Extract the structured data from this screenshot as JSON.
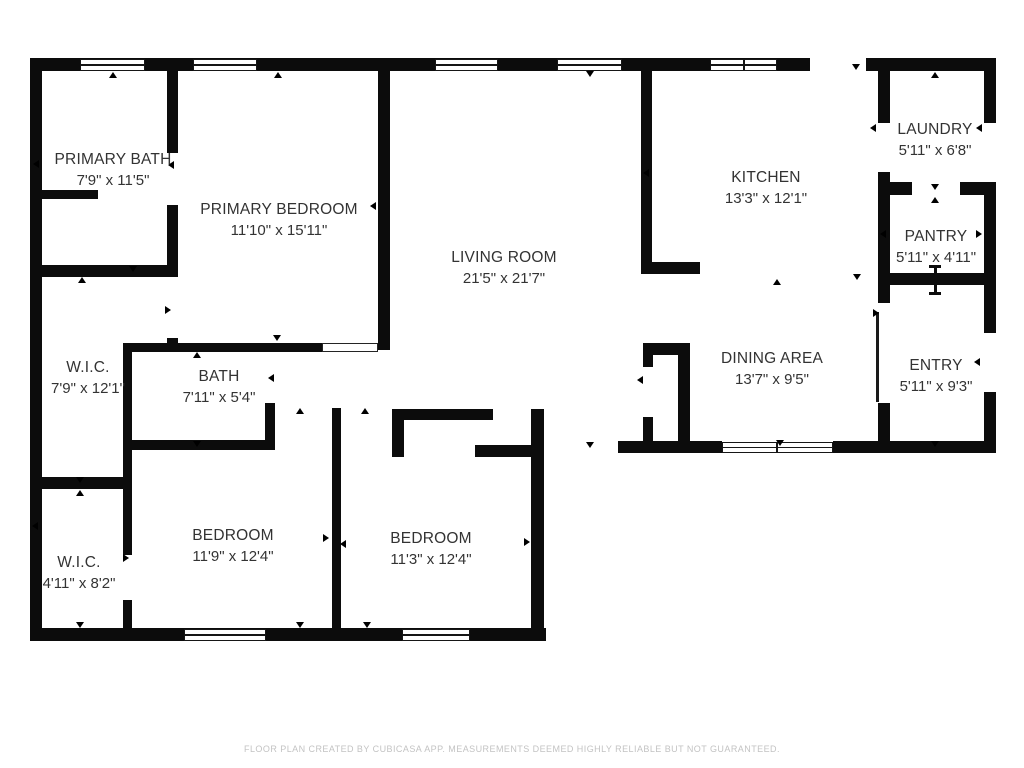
{
  "footer": {
    "text": "FLOOR PLAN CREATED BY CUBICASA APP. MEASUREMENTS DEEMED HIGHLY RELIABLE BUT NOT GUARANTEED."
  },
  "colors": {
    "wall": "#0c0c0c",
    "room_text": "#333333",
    "footer_text": "#c3c3c3",
    "background": "#ffffff"
  },
  "rooms": [
    {
      "name": "PRIMARY BATH",
      "dims": "7'9\" x 11'5\"",
      "cx": 113,
      "cy": 170
    },
    {
      "name": "PRIMARY BEDROOM",
      "dims": "11'10\" x 15'11\"",
      "cx": 279,
      "cy": 220
    },
    {
      "name": "LIVING ROOM",
      "dims": "21'5\" x 21'7\"",
      "cx": 504,
      "cy": 268
    },
    {
      "name": "KITCHEN",
      "dims": "13'3\" x 12'1\"",
      "cx": 766,
      "cy": 188
    },
    {
      "name": "LAUNDRY",
      "dims": "5'11\" x 6'8\"",
      "cx": 935,
      "cy": 140
    },
    {
      "name": "PANTRY",
      "dims": "5'11\" x 4'11\"",
      "cx": 936,
      "cy": 247
    },
    {
      "name": "ENTRY",
      "dims": "5'11\" x 9'3\"",
      "cx": 936,
      "cy": 376
    },
    {
      "name": "DINING AREA",
      "dims": "13'7\" x 9'5\"",
      "cx": 772,
      "cy": 369
    },
    {
      "name": "W.I.C.",
      "dims": "7'9\" x 12'1\"",
      "cx": 88,
      "cy": 378
    },
    {
      "name": "BATH",
      "dims": "7'11\" x 5'4\"",
      "cx": 219,
      "cy": 387
    },
    {
      "name": "W.I.C.",
      "dims": "4'11\" x 8'2\"",
      "cx": 79,
      "cy": 573
    },
    {
      "name": "BEDROOM",
      "dims": "11'9\" x 12'4\"",
      "cx": 233,
      "cy": 546
    },
    {
      "name": "BEDROOM",
      "dims": "11'3\" x 12'4\"",
      "cx": 431,
      "cy": 549
    }
  ],
  "plan": {
    "walls": [
      [
        30,
        58,
        780,
        13
      ],
      [
        866,
        58,
        130,
        13
      ],
      [
        30,
        58,
        12,
        583
      ],
      [
        30,
        628,
        516,
        13
      ],
      [
        984,
        58,
        12,
        65
      ],
      [
        984,
        185,
        12,
        148
      ],
      [
        984,
        392,
        12,
        61
      ],
      [
        618,
        441,
        104,
        12
      ],
      [
        833,
        441,
        163,
        12
      ],
      [
        531,
        409,
        13,
        232
      ],
      [
        167,
        58,
        11,
        95
      ],
      [
        167,
        205,
        11,
        72
      ],
      [
        167,
        338,
        11,
        14
      ],
      [
        30,
        190,
        68,
        9
      ],
      [
        30,
        265,
        148,
        12
      ],
      [
        123,
        343,
        199,
        9
      ],
      [
        123,
        343,
        9,
        212
      ],
      [
        123,
        600,
        9,
        41
      ],
      [
        30,
        477,
        101,
        12
      ],
      [
        265,
        403,
        10,
        47
      ],
      [
        123,
        440,
        147,
        10
      ],
      [
        332,
        408,
        9,
        233
      ],
      [
        392,
        409,
        101,
        11
      ],
      [
        392,
        420,
        12,
        37
      ],
      [
        475,
        445,
        56,
        12
      ],
      [
        378,
        58,
        12,
        292
      ],
      [
        641,
        58,
        11,
        216
      ],
      [
        641,
        262,
        59,
        12
      ],
      [
        643,
        343,
        47,
        12
      ],
      [
        643,
        343,
        10,
        24
      ],
      [
        643,
        417,
        10,
        36
      ],
      [
        678,
        343,
        12,
        110
      ],
      [
        878,
        71,
        12,
        52
      ],
      [
        878,
        172,
        12,
        131
      ],
      [
        878,
        403,
        12,
        50
      ],
      [
        878,
        182,
        34,
        13
      ],
      [
        960,
        182,
        36,
        13
      ],
      [
        878,
        273,
        118,
        12
      ]
    ],
    "windows": [
      [
        80,
        59,
        65,
        12
      ],
      [
        193,
        59,
        64,
        12
      ],
      [
        435,
        59,
        63,
        12
      ],
      [
        557,
        59,
        65,
        12
      ],
      [
        710,
        59,
        34,
        12
      ],
      [
        744,
        59,
        33,
        12
      ],
      [
        184,
        629,
        82,
        12
      ],
      [
        402,
        629,
        68,
        12
      ],
      [
        722,
        442,
        55,
        11
      ],
      [
        777,
        442,
        56,
        11
      ]
    ],
    "opening": [
      322,
      343,
      56,
      9
    ],
    "door_leaf": [
      876,
      312,
      3,
      90
    ],
    "threshold": [
      935,
      280
    ],
    "markers": [
      [
        113,
        76,
        "up"
      ],
      [
        278,
        76,
        "up"
      ],
      [
        590,
        75,
        "down"
      ],
      [
        856,
        68,
        "down"
      ],
      [
        935,
        76,
        "up"
      ],
      [
        874,
        128,
        "left"
      ],
      [
        980,
        128,
        "left"
      ],
      [
        935,
        188,
        "down"
      ],
      [
        935,
        201,
        "up"
      ],
      [
        884,
        234,
        "left"
      ],
      [
        980,
        234,
        "right"
      ],
      [
        777,
        283,
        "up"
      ],
      [
        857,
        278,
        "down"
      ],
      [
        647,
        173,
        "left"
      ],
      [
        37,
        164,
        "left"
      ],
      [
        172,
        165,
        "left"
      ],
      [
        374,
        206,
        "left"
      ],
      [
        133,
        270,
        "down"
      ],
      [
        82,
        281,
        "up"
      ],
      [
        169,
        310,
        "right"
      ],
      [
        277,
        339,
        "down"
      ],
      [
        197,
        356,
        "up"
      ],
      [
        272,
        378,
        "left"
      ],
      [
        197,
        445,
        "down"
      ],
      [
        300,
        412,
        "up"
      ],
      [
        365,
        412,
        "up"
      ],
      [
        327,
        538,
        "right"
      ],
      [
        344,
        544,
        "left"
      ],
      [
        80,
        481,
        "down"
      ],
      [
        80,
        494,
        "up"
      ],
      [
        36,
        526,
        "left"
      ],
      [
        127,
        558,
        "right"
      ],
      [
        80,
        626,
        "down"
      ],
      [
        300,
        626,
        "down"
      ],
      [
        367,
        626,
        "down"
      ],
      [
        528,
        542,
        "right"
      ],
      [
        590,
        446,
        "down"
      ],
      [
        641,
        380,
        "left"
      ],
      [
        877,
        313,
        "right"
      ],
      [
        978,
        362,
        "left"
      ],
      [
        935,
        445,
        "down"
      ],
      [
        780,
        444,
        "down"
      ]
    ]
  }
}
